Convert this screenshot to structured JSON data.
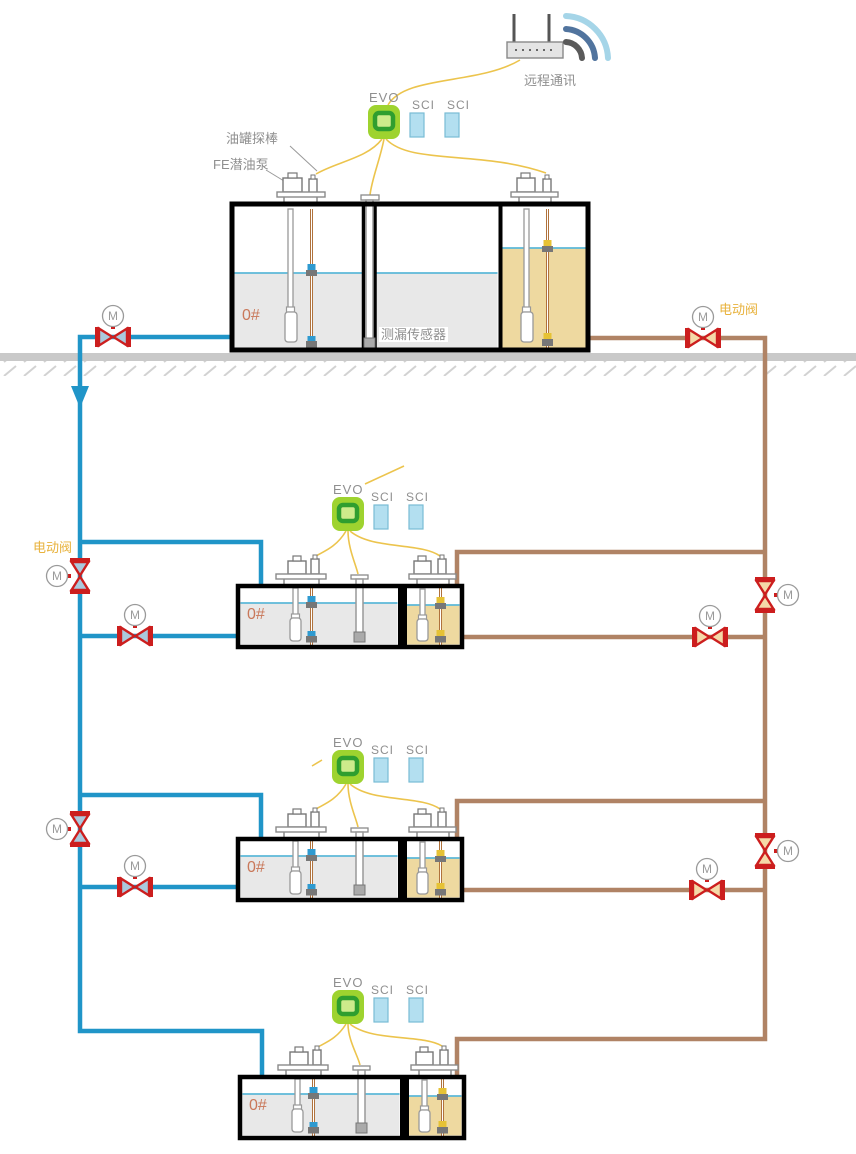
{
  "labels": {
    "remote_comm": "远程通讯",
    "evo": "EVO",
    "sci": "SCI",
    "tank_probe": "油罐探棒",
    "fe_pump": "FE潜油泵",
    "leak_sensor": "测漏传感器",
    "electric_valve": "电动阀",
    "tank_grade": "0#",
    "motor": "M"
  },
  "colors": {
    "pipe_blue": "#2095c8",
    "pipe_brown": "#b08365",
    "wire_yellow": "#ecc44d",
    "valve_red": "#cc1e1e",
    "valve_fill_blue": "#aac9dd",
    "valve_fill_tan": "#f5d9a8",
    "evo_green": "#9ed32f",
    "evo_ring_green": "#2f9e2f",
    "sci_blue": "#b3dff0",
    "fuel_gray": "#e8e8e8",
    "fuel_tan": "#eed9a0",
    "waterline_blue": "#5cb8d8",
    "ground_gray": "#c9c9c9",
    "label_gray": "#8f8f8f",
    "grade_orange": "#c9785a",
    "valve_label_orange": "#e8b23c"
  }
}
